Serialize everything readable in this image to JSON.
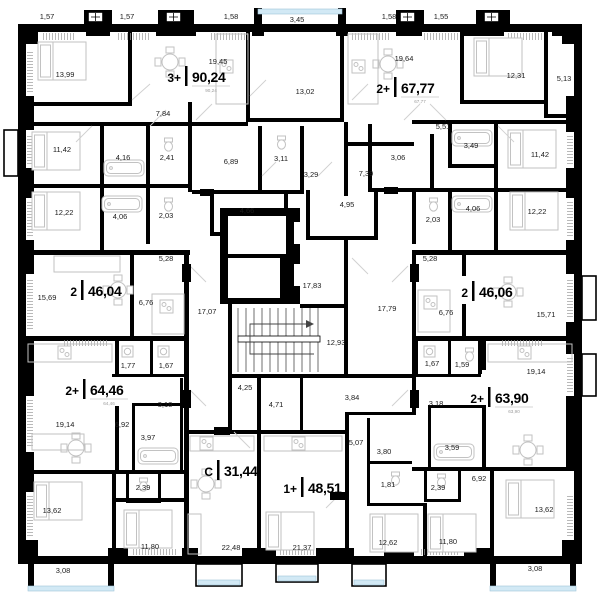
{
  "apartments": [
    {
      "code": "3+",
      "area": "90,24",
      "area_sub": "90,24"
    },
    {
      "code": "2+",
      "area": "67,77",
      "area_sub": "67,77"
    },
    {
      "code": "2",
      "area": "46,04"
    },
    {
      "code": "2",
      "area": "46,06"
    },
    {
      "code": "2+",
      "area": "64,46",
      "area_sub": "64,46"
    },
    {
      "code": "2+",
      "area": "63,90",
      "area_sub": "63,90"
    },
    {
      "code": "C",
      "area": "31,44"
    },
    {
      "code": "1+",
      "area": "48,51"
    }
  ],
  "labels": [
    "1,57",
    "1,57",
    "1,58",
    "3,45",
    "1,58",
    "1,55",
    "13,99",
    "19,45",
    "19,64",
    "12,31",
    "5,13",
    "13,02",
    "7,84",
    "11,42",
    "4,16",
    "2,41",
    "6,89",
    "3,11",
    "5,51",
    "3,49",
    "3,06",
    "11,42",
    "3,29",
    "7,39",
    "12,22",
    "4,06",
    "2,03",
    "4,66",
    "4,95",
    "2,03",
    "4,06",
    "12,22",
    "5,28",
    "5,28",
    "15,69",
    "6,76",
    "6,76",
    "15,71",
    "17,07",
    "17,83",
    "17,79",
    "12,93",
    "1,77",
    "1,67",
    "1,67",
    "1,59",
    "3,18",
    "3,18",
    "19,14",
    "6,92",
    "3,97",
    "4,25",
    "4,71",
    "3,84",
    "5,07",
    "3,80",
    "3,59",
    "19,14",
    "6,92",
    "2,39",
    "1,81",
    "2,39",
    "13,62",
    "11,80",
    "22,48",
    "21,37",
    "12,62",
    "13,62",
    "11,80",
    "3,08",
    "3,08"
  ]
}
